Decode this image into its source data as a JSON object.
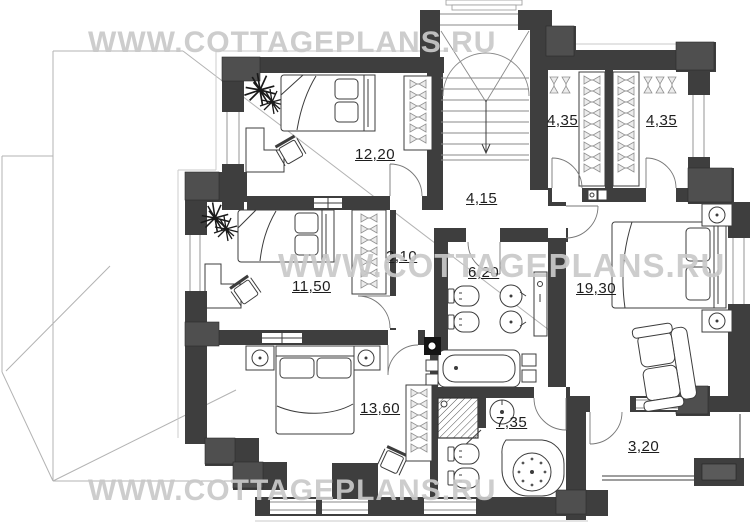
{
  "watermark": {
    "text": "WWW.COTTAGEPLANS.RU"
  },
  "plan": {
    "rooms": [
      {
        "id": "bedroom-top",
        "kind": "bedroom",
        "area_label": "12,20"
      },
      {
        "id": "bedroom-middle",
        "kind": "bedroom",
        "area_label": "11,50"
      },
      {
        "id": "bedroom-bottom",
        "kind": "bedroom",
        "area_label": "13,60"
      },
      {
        "id": "master-bedroom",
        "kind": "bedroom",
        "area_label": "19,30"
      },
      {
        "id": "wardrobe-left",
        "kind": "walk-in-closet",
        "area_label": "4,35"
      },
      {
        "id": "wardrobe-right",
        "kind": "walk-in-closet",
        "area_label": "4,35"
      },
      {
        "id": "hall",
        "kind": "hall",
        "area_label": "4,15"
      },
      {
        "id": "corridor",
        "kind": "corridor",
        "area_label": "3,10"
      },
      {
        "id": "bathroom-main",
        "kind": "bathroom",
        "area_label": "6,20"
      },
      {
        "id": "bathroom-ensuite",
        "kind": "bathroom",
        "area_label": "7,35"
      },
      {
        "id": "balcony",
        "kind": "balcony",
        "area_label": "3,20"
      }
    ]
  },
  "colors": {
    "wall": "#3e3e3e",
    "quoin": "#4f4f4f",
    "line": "#3c3c3c",
    "roof": "#b3b3b3",
    "label": "#1e1e1e",
    "watermark": "#c9c9c9",
    "bg": "#ffffff"
  }
}
